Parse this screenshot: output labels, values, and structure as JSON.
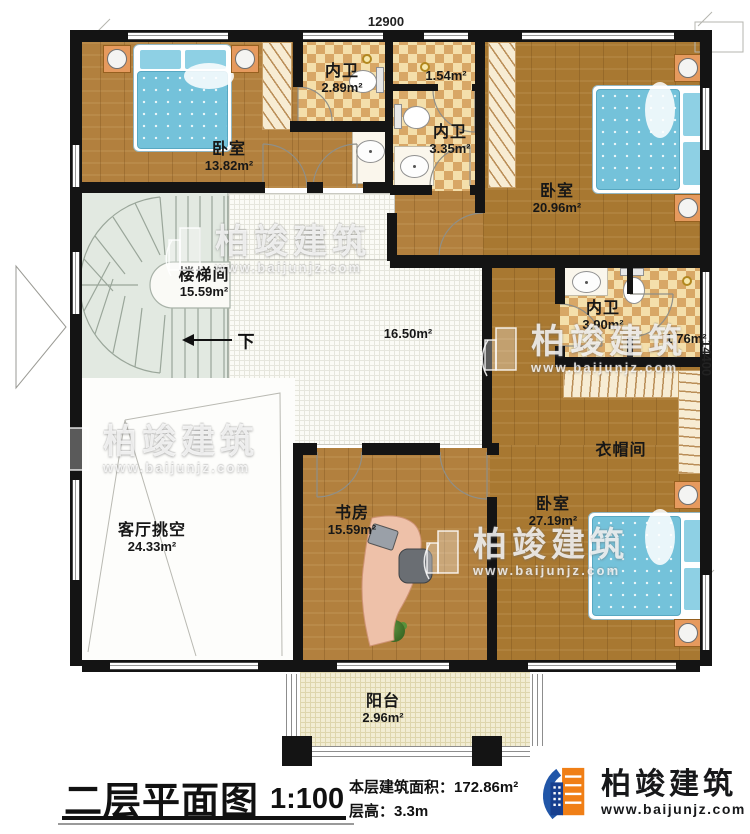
{
  "dimensions": {
    "top": "12900",
    "right": "14400"
  },
  "rooms": [
    {
      "id": "bedroom-top-left",
      "name": "卧室",
      "area": "13.82m²"
    },
    {
      "id": "bath-top-left",
      "name": "内卫",
      "area": "2.89m²"
    },
    {
      "id": "shower-top",
      "name": "",
      "area": "1.54m²"
    },
    {
      "id": "bath-top-center",
      "name": "内卫",
      "area": "3.35m²"
    },
    {
      "id": "bedroom-top-right",
      "name": "卧室",
      "area": "20.96m²"
    },
    {
      "id": "stair-hall",
      "name": "楼梯间",
      "area": "15.59m²"
    },
    {
      "id": "hallway",
      "name": "",
      "area": "16.50m²"
    },
    {
      "id": "bath-right",
      "name": "内卫",
      "area": "3.90m²"
    },
    {
      "id": "shower-right",
      "name": "",
      "area": "1.76m²"
    },
    {
      "id": "cloakroom",
      "name": "衣帽间",
      "area": ""
    },
    {
      "id": "living-void",
      "name": "客厅挑空",
      "area": "24.33m²"
    },
    {
      "id": "study",
      "name": "书房",
      "area": "15.59m²"
    },
    {
      "id": "bedroom-bottom",
      "name": "卧室",
      "area": "27.19m²"
    },
    {
      "id": "balcony",
      "name": "阳台",
      "area": "2.96m²"
    }
  ],
  "stairs": {
    "down_label": "下"
  },
  "title_block": {
    "title": "二层平面图",
    "scale": "1:100",
    "area_label": "本层建筑面积：",
    "area_value": "172.86m²",
    "height_label": "层高：",
    "height_value": "3.3m"
  },
  "brand": {
    "name": "柏竣建筑",
    "website": "www.baijunjz.com"
  },
  "watermark": {
    "name": "柏竣建筑",
    "website": "www.baijunjz.com"
  },
  "colors": {
    "wall": "#141414",
    "wood": "#b2803e",
    "tile_light": "#f4dfab",
    "tile_dark": "#d8a766",
    "stair": "#e2e9e1",
    "bed_blue": "#74c2da",
    "balcony": "#f2edd3",
    "logo_orange": "#f07f16",
    "logo_blue": "#1d4b9e"
  }
}
